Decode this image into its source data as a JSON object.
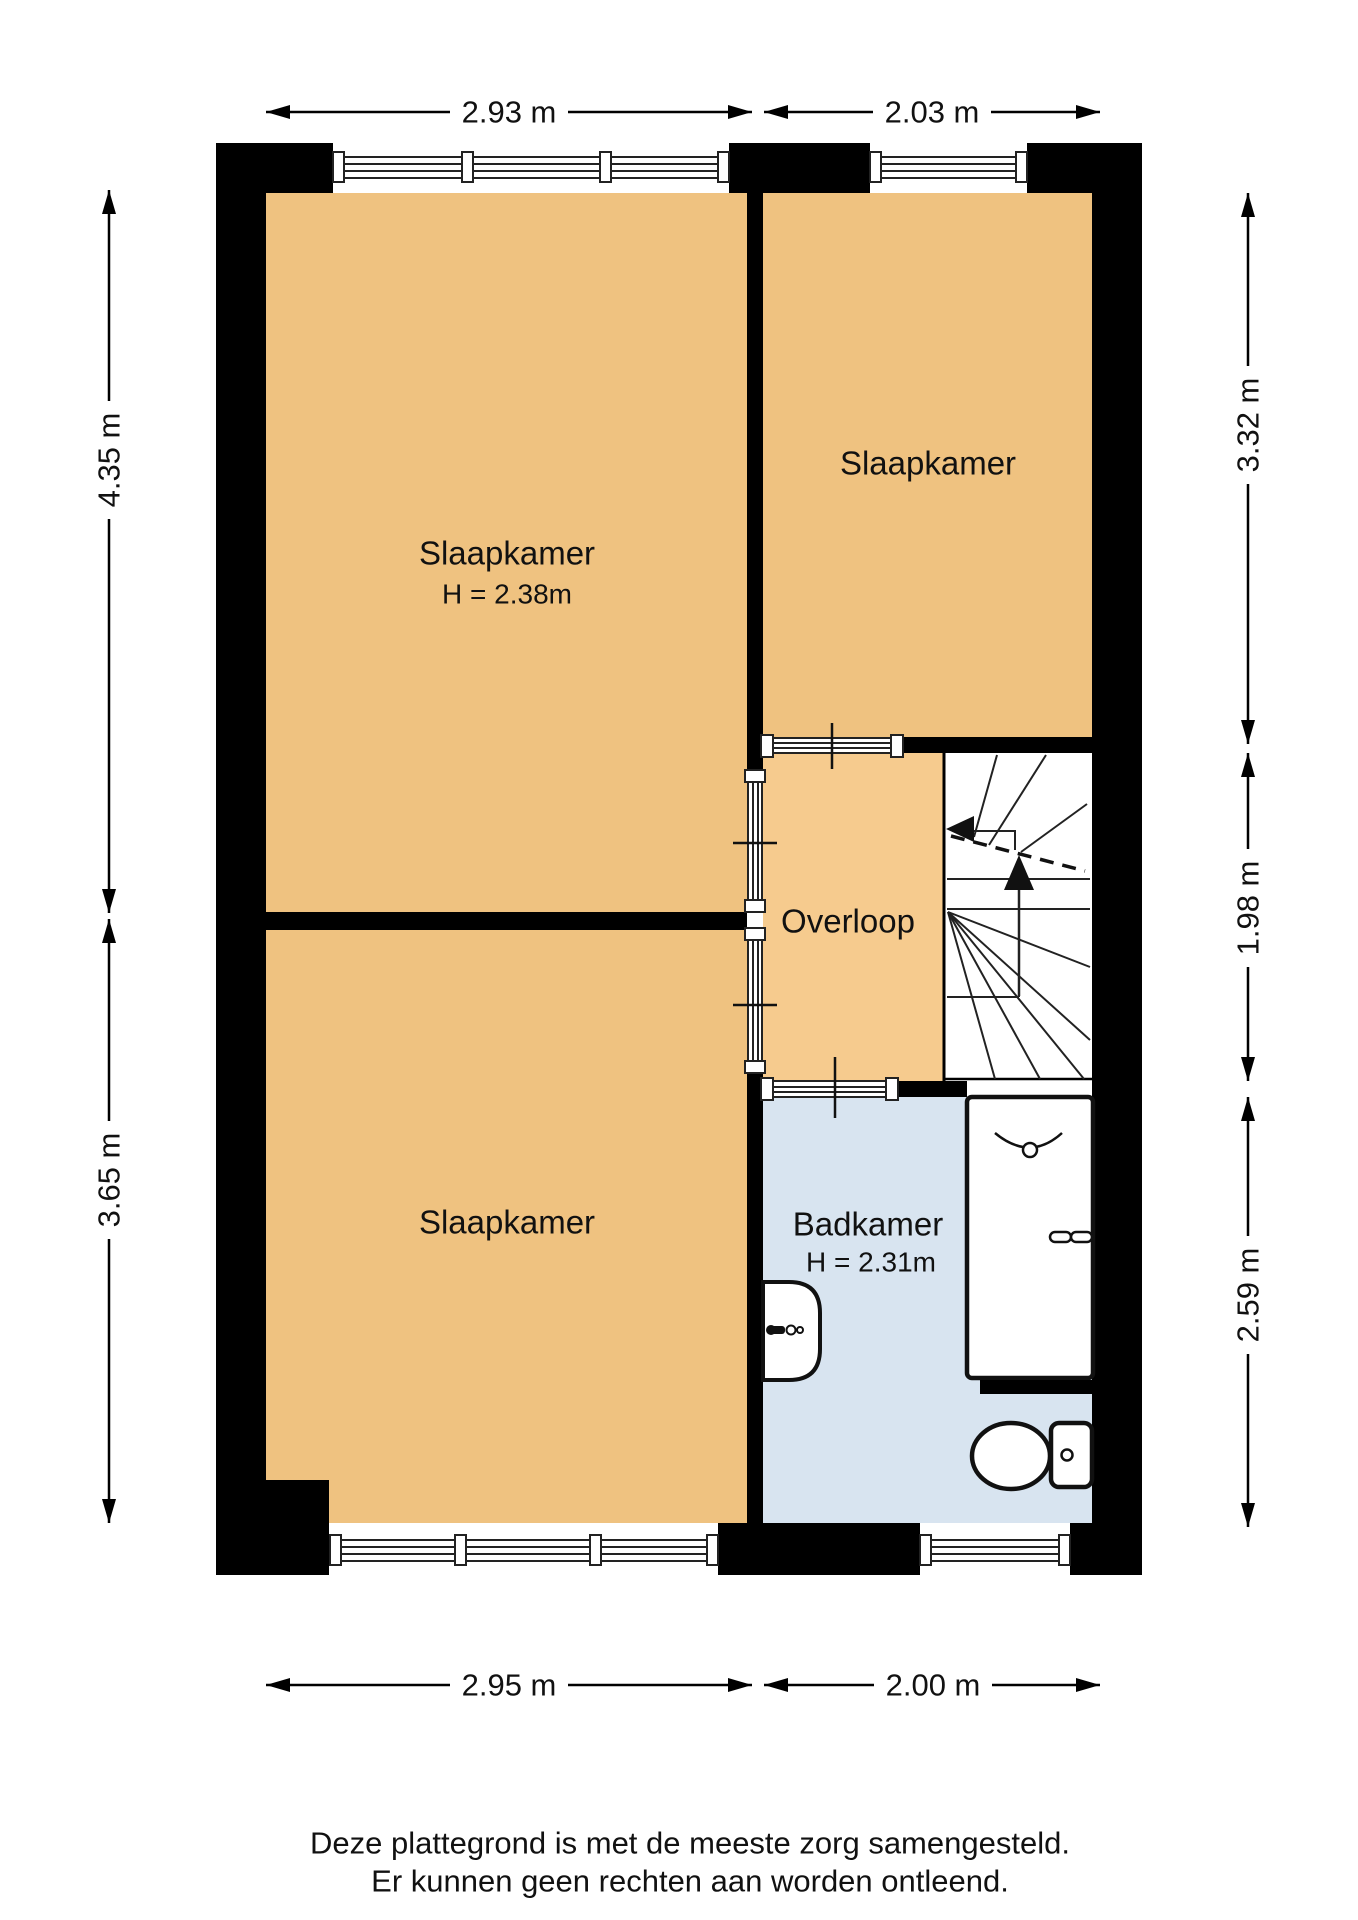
{
  "rooms": {
    "bedroom_large": {
      "label": "Slaapkamer",
      "height_note": "H = 2.38m"
    },
    "bedroom_topright": {
      "label": "Slaapkamer"
    },
    "bedroom_bottomleft": {
      "label": "Slaapkamer"
    },
    "landing": {
      "label": "Overloop"
    },
    "bathroom": {
      "label": "Badkamer",
      "height_note": "H = 2.31m"
    }
  },
  "dims": {
    "top": [
      "2.93 m",
      "2.03 m"
    ],
    "bottom": [
      "2.95 m",
      "2.00 m"
    ],
    "left": [
      "4.35 m",
      "3.65 m"
    ],
    "right": [
      "3.32 m",
      "1.98 m",
      "2.59 m"
    ]
  },
  "disclaimer": {
    "line1": "Deze plattegrond is met de meeste zorg samengesteld.",
    "line2": "Er kunnen geen rechten aan worden ontleend."
  },
  "colors": {
    "room": "#EFC280",
    "landing": "#F6CB8E",
    "bathroom": "#D8E4F0",
    "wall": "#000000",
    "fixture_stroke": "#111111"
  }
}
